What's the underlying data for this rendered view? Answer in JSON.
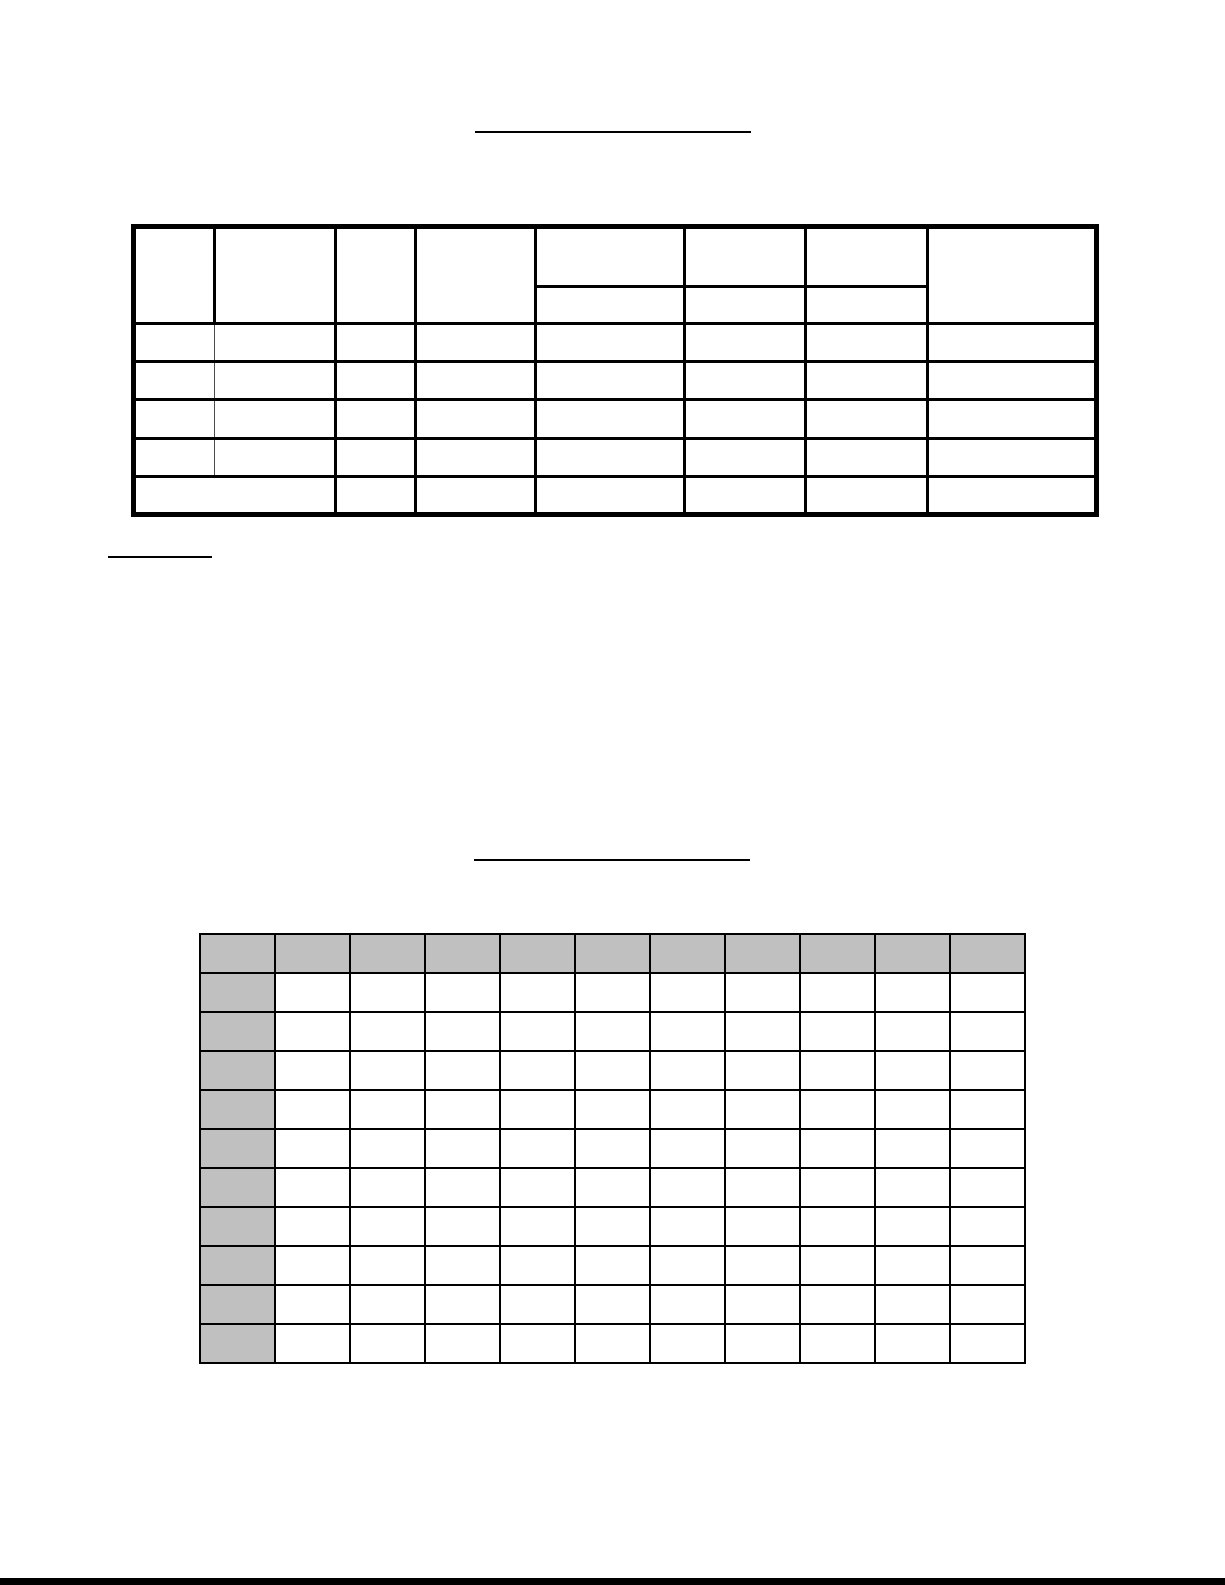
{
  "page": {
    "background": "#ffffff",
    "border_color": "#000000",
    "bottom_edge_color": "#000000"
  },
  "blanks": {
    "title_blank_top": "",
    "notes_blank": "",
    "title_blank_middle": ""
  },
  "summary_table": {
    "border_color": "#000000",
    "thin_divider_color": "#4d4d4d",
    "columns": 8,
    "header_top_cells": [
      "",
      "",
      "",
      "",
      "",
      "",
      "",
      ""
    ],
    "header_sub_cells": [
      "",
      "",
      ""
    ],
    "split_header_columns": [
      4,
      5,
      6
    ],
    "data_rows": [
      [
        "",
        "",
        "",
        "",
        "",
        "",
        "",
        ""
      ],
      [
        "",
        "",
        "",
        "",
        "",
        "",
        "",
        ""
      ],
      [
        "",
        "",
        "",
        "",
        "",
        "",
        "",
        ""
      ],
      [
        "",
        "",
        "",
        "",
        "",
        "",
        "",
        ""
      ]
    ],
    "footer_row": [
      "",
      "",
      "",
      "",
      "",
      "",
      ""
    ]
  },
  "grid_table": {
    "border_color": "#000000",
    "header_fill": "#c0c0c0",
    "columns": 11,
    "rows": 11,
    "cells": [
      [
        "",
        "",
        "",
        "",
        "",
        "",
        "",
        "",
        "",
        "",
        ""
      ],
      [
        "",
        "",
        "",
        "",
        "",
        "",
        "",
        "",
        "",
        "",
        ""
      ],
      [
        "",
        "",
        "",
        "",
        "",
        "",
        "",
        "",
        "",
        "",
        ""
      ],
      [
        "",
        "",
        "",
        "",
        "",
        "",
        "",
        "",
        "",
        "",
        ""
      ],
      [
        "",
        "",
        "",
        "",
        "",
        "",
        "",
        "",
        "",
        "",
        ""
      ],
      [
        "",
        "",
        "",
        "",
        "",
        "",
        "",
        "",
        "",
        "",
        ""
      ],
      [
        "",
        "",
        "",
        "",
        "",
        "",
        "",
        "",
        "",
        "",
        ""
      ],
      [
        "",
        "",
        "",
        "",
        "",
        "",
        "",
        "",
        "",
        "",
        ""
      ],
      [
        "",
        "",
        "",
        "",
        "",
        "",
        "",
        "",
        "",
        "",
        ""
      ],
      [
        "",
        "",
        "",
        "",
        "",
        "",
        "",
        "",
        "",
        "",
        ""
      ],
      [
        "",
        "",
        "",
        "",
        "",
        "",
        "",
        "",
        "",
        "",
        ""
      ]
    ]
  }
}
